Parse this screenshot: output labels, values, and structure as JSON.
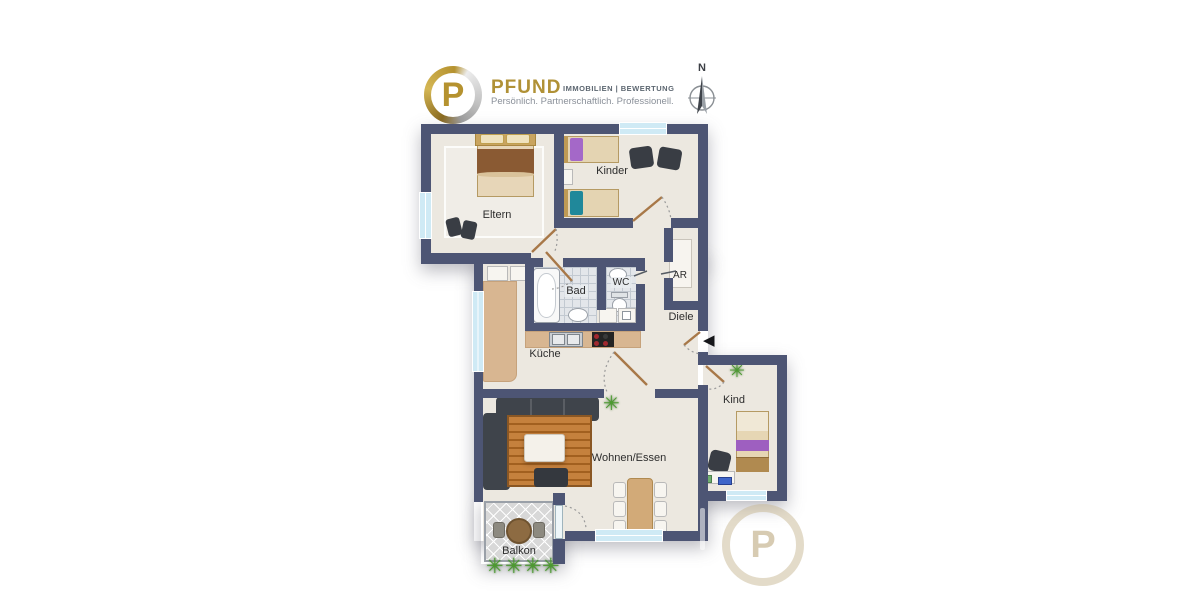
{
  "branding": {
    "logo_letter": "P",
    "name": "PFUND",
    "division": "IMMOBILIEN | BEWERTUNG",
    "tagline": "Persönlich. Partnerschaftlich. Professionell."
  },
  "compass": {
    "north_label": "N"
  },
  "floorplan": {
    "rooms": [
      {
        "id": "eltern",
        "label": "Eltern"
      },
      {
        "id": "kinder",
        "label": "Kinder"
      },
      {
        "id": "bad",
        "label": "Bad"
      },
      {
        "id": "wc",
        "label": "WC"
      },
      {
        "id": "ar",
        "label": "AR"
      },
      {
        "id": "diele",
        "label": "Diele"
      },
      {
        "id": "kueche",
        "label": "Küche"
      },
      {
        "id": "wohnen_essen",
        "label": "Wohnen/Essen"
      },
      {
        "id": "kind",
        "label": "Kind"
      },
      {
        "id": "balkon",
        "label": "Balkon"
      }
    ]
  },
  "icons": {
    "plant": "✳",
    "entrance_arrow": "◀"
  },
  "watermark": {
    "logo_letter": "P"
  },
  "colors": {
    "wall": "#4d5574",
    "floor": "#ece8e0",
    "window_glass": "#cfeaf5",
    "bath_tile": "#e3e6ea",
    "kitchen_counter": "#d8b691",
    "brand_gold": "#b09136",
    "door_wood": "#a87848"
  }
}
